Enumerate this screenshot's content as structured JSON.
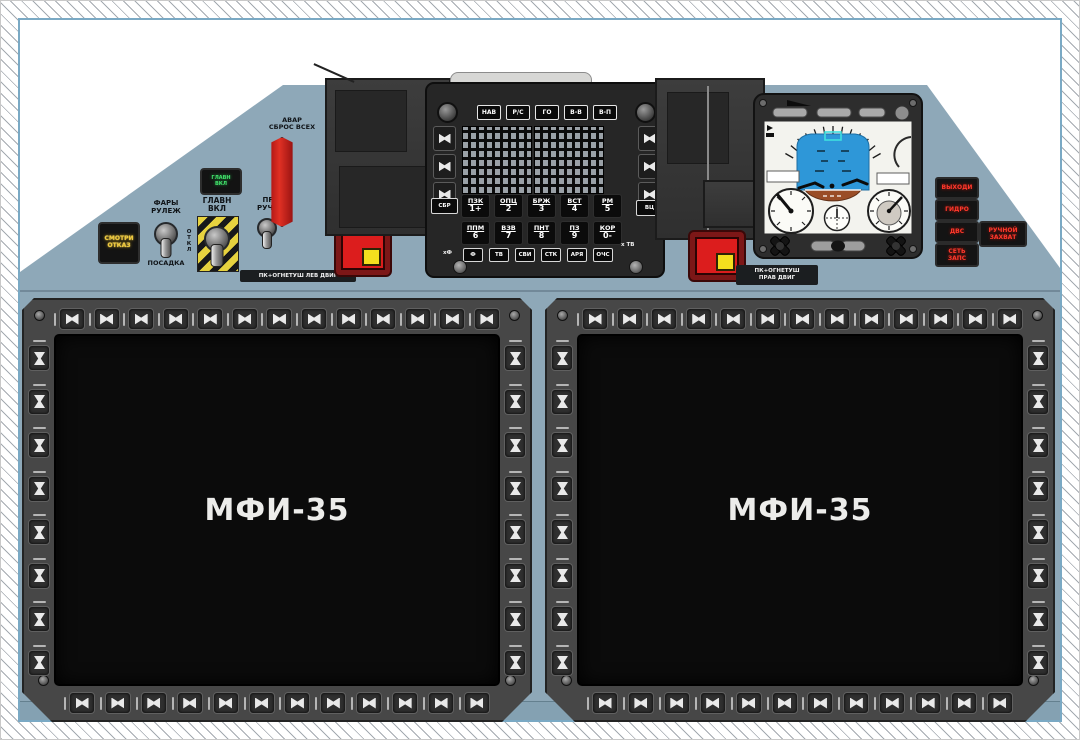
{
  "colors": {
    "panel_blue_grey": "#8ea8b8",
    "frame_border_blue": "#7aa9c4",
    "hazard_yellow": "#e6d23f",
    "fire_red": "#dc1d1d",
    "fire_yellow": "#f4df1e",
    "led_green": "#43e26c",
    "led_amber": "#eec93d",
    "led_red": "#ff392c",
    "screen_black": "#0b0b0b",
    "attitude_sky_blue": "#2e97d8",
    "attitude_ground_brown": "#9a4d27"
  },
  "left_cluster": {
    "smotri_otkaz": "СМОТРИ\nОТКАЗ",
    "fary_label": "ФАРЫ\nРУЛЕЖ",
    "otkl_label": "ОТКЛ",
    "posadka_label": "ПОСАДКА",
    "green_annunciator": "ГЛАВН\nВКЛ",
    "glavn_label": "ГЛАВН\nВКЛ",
    "pr_ruchn_label": "ПР\nРУЧН",
    "avar_label": "АВАР\nСБРОС ВСЕХ"
  },
  "fire_panels": {
    "left_label": "ПК+ОГНЕТУШ ЛЕВ ДВИГ",
    "right_label": "ПК+ОГНЕТУШ\nПРАВ ДВИГ"
  },
  "keyboard": {
    "mode_row": [
      "НАВ",
      "Р/С",
      "ГО",
      "В-В",
      "В-П"
    ],
    "sbr_key": "СБР",
    "vc_key": "ВЦ",
    "num_row1": [
      {
        "top": "ПЗК",
        "num": "1+"
      },
      {
        "top": "ОПЦ",
        "num": "2"
      },
      {
        "top": "БРЖ",
        "num": "3"
      },
      {
        "top": "ВСТ",
        "num": "4"
      },
      {
        "top": "РМ",
        "num": "5"
      }
    ],
    "num_row2": [
      {
        "top": "ППМ",
        "num": "6"
      },
      {
        "top": "ВЗВ",
        "num": "7"
      },
      {
        "top": "ПНТ",
        "num": "8"
      },
      {
        "top": "ПЗ",
        "num": "9"
      },
      {
        "top": "КОР",
        "num": "0-"
      }
    ],
    "func_row": [
      "Ф",
      "ТВ",
      "СВИ",
      "СТК",
      "АРЯ",
      "ОЧС"
    ],
    "left_note": "хФ",
    "right_note": "х ТВ"
  },
  "warnings": {
    "stack": [
      "ВЫХОДИ",
      "ГИДРО",
      "ДВС",
      "СЕТЬ\nЗАПС"
    ],
    "side": "РУЧНОЙ\nЗАХВАТ"
  },
  "displays": {
    "label": "МФИ-35",
    "bezel_buttons": {
      "top": 13,
      "bottom": 12,
      "left": 8,
      "right": 8
    }
  }
}
